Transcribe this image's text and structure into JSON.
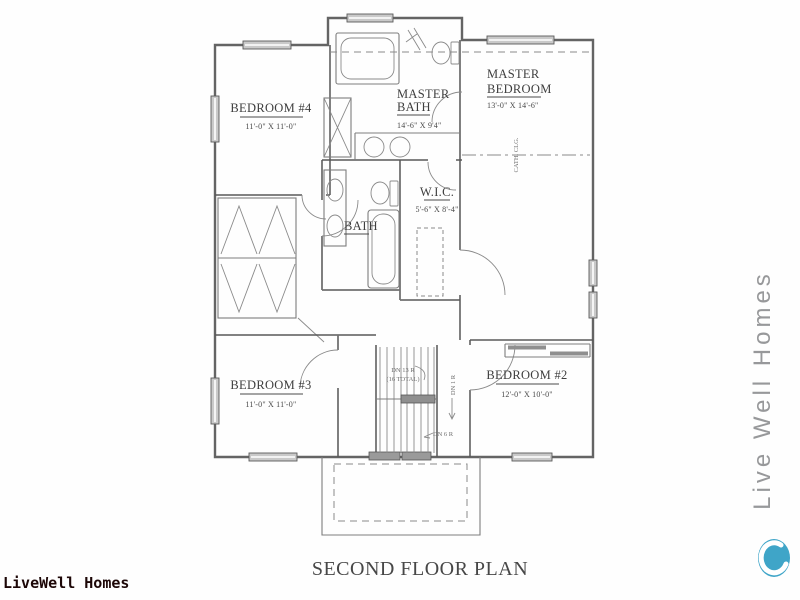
{
  "title": "SECOND FLOOR PLAN",
  "branding": {
    "bottom_left": "LiveWell Homes",
    "right_vertical": "Live Well Homes",
    "logo_color": "#3fa5c8"
  },
  "rooms": {
    "bedroom4": {
      "name": "BEDROOM #4",
      "dims": "11'-0\" X 11'-0\""
    },
    "master_bath": {
      "line1": "MASTER",
      "line2": "BATH",
      "dims": "14'-6\" X 9'4\""
    },
    "master_bedroom": {
      "line1": "MASTER",
      "line2": "BEDROOM",
      "dims": "13'-0\" X 14'-6\""
    },
    "wic": {
      "name": "W.I.C.",
      "dims": "5'-6\" X 8'-4\""
    },
    "bath": {
      "name": "BATH"
    },
    "bedroom3": {
      "name": "BEDROOM #3",
      "dims": "11'-0\" X 11'-0\""
    },
    "bedroom2": {
      "name": "BEDROOM #2",
      "dims": "12'-0\" X 10'-0\""
    }
  },
  "annotations": {
    "stairs_dn": "DN 13 R",
    "stairs_total": "(16 TOTAL)",
    "hall_dn": "DN 1 R",
    "lower_dn": "DN 6 R",
    "ceiling": "CATH. CLG."
  }
}
